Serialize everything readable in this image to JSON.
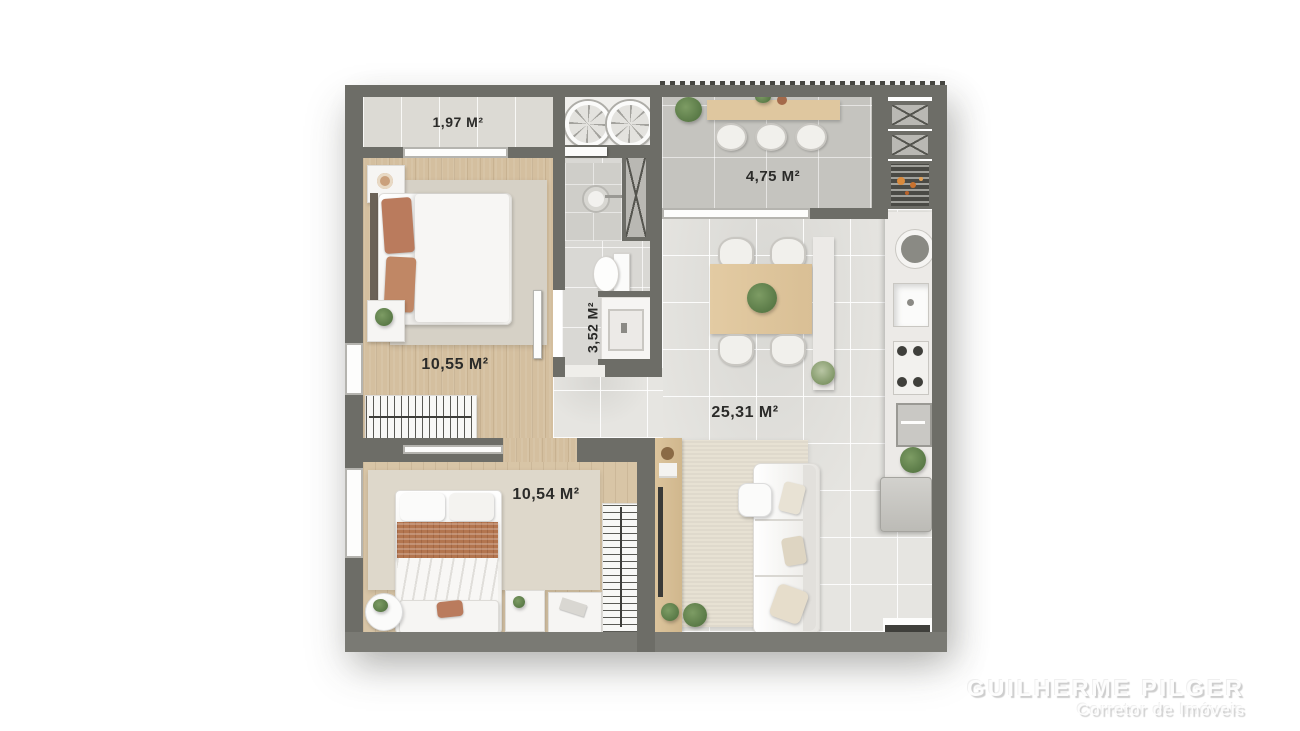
{
  "plan": {
    "rooms": {
      "balcony": {
        "name": "small-balcony",
        "area": "1,97 M²"
      },
      "terrace": {
        "name": "terrace-balcony",
        "area": "4,75 M²"
      },
      "bedroom1": {
        "name": "bedroom-1",
        "area": "10,55 M²"
      },
      "bathroom": {
        "name": "bathroom",
        "area": "3,52 M²"
      },
      "living": {
        "name": "living-kitchen",
        "area": "25,31 M²"
      },
      "bedroom2": {
        "name": "bedroom-2",
        "area": "10,54 M²"
      }
    },
    "fixtures": [
      "washer-drum",
      "dryer-drum",
      "shower",
      "toilet",
      "vanity-sink",
      "duct-shaft",
      "grill",
      "kitchen-sink",
      "stove",
      "oven",
      "fridge",
      "dining-table",
      "kitchen-island",
      "bar-counter",
      "sofa",
      "tv-console",
      "bed",
      "wardrobe",
      "nightstand",
      "rug",
      "plant"
    ],
    "colors": {
      "wall": "#6d6d67",
      "wood_floor": "#d4bf9f",
      "tile_floor": "#e6e5e1",
      "terrace_tile": "#c5c4bf",
      "terracotta": "#ba7b5d",
      "label_text": "#2b2b29"
    }
  },
  "watermark": {
    "name": "GUILHERME PILGER",
    "title": "Corretor de Imóveis"
  }
}
